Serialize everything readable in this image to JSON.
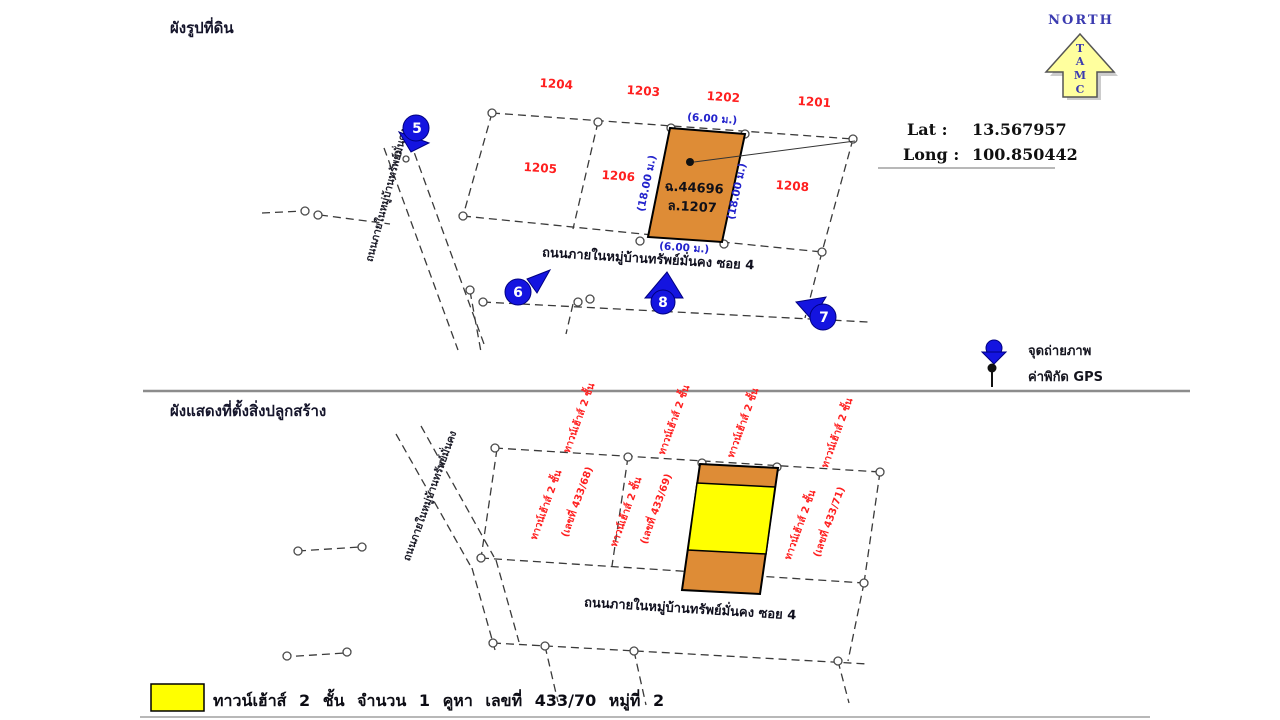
{
  "colors": {
    "parcel_red": "#ff1f1f",
    "dimension_blue": "#2323cc",
    "marker_blue": "#1414e0",
    "subject_plot_orange": "#de8c36",
    "subject_building_yellow": "#ffff00",
    "north_arrow_yellow": "#ffff9e"
  },
  "top": {
    "title": "ผังรูปที่ดิน",
    "north": {
      "label": "NORTH",
      "letters": [
        "T",
        "A",
        "M",
        "C"
      ]
    },
    "gps": {
      "lat_label": "Lat :",
      "lat_value": "13.567957",
      "long_label": "Long :",
      "long_value": "100.850442"
    },
    "parcels": {
      "p1201": "1201",
      "p1202": "1202",
      "p1203": "1203",
      "p1204": "1204",
      "p1205": "1205",
      "p1206": "1206",
      "p1208": "1208"
    },
    "subject": {
      "deed_no": "ฉ.44696",
      "parcel_no": "ล.1207",
      "width_top": "(6.00 ม.)",
      "width_bottom": "(6.00 ม.)",
      "depth_left": "(18.00 ม.)",
      "depth_right": "(18.00 ม.)"
    },
    "roads": {
      "vertical": "ถนนภายในหมู่บ้านทรัพย์มั่นคง",
      "horizontal": "ถนนภายในหมู่บ้านทรัพย์มั่นคง ซอย 4"
    },
    "photo_markers": {
      "m5": "5",
      "m6": "6",
      "m7": "7",
      "m8": "8"
    },
    "legend": {
      "photo_point": "จุดถ่ายภาพ",
      "gps_point": "ค่าพิกัด GPS"
    }
  },
  "bottom": {
    "title": "ผังแสดงที่ตั้งสิ่งปลูกสร้าง",
    "row_labels": [
      "ทาวน์เฮ้าส์ 2 ชั้น",
      "ทาวน์เฮ้าส์ 2 ชั้น",
      "ทาวน์เฮ้าส์ 2 ชั้น",
      "ทาวน์เฮ้าส์ 2 ชั้น"
    ],
    "units": [
      {
        "name": "ทาวน์เฮ้าส์ 2 ชั้น",
        "number": "(เลขที่ 433/68)"
      },
      {
        "name": "ทาวน์เฮ้าส์ 2 ชั้น",
        "number": "(เลขที่ 433/69)"
      },
      {
        "name": "ทาวน์เฮ้าส์ 2 ชั้น",
        "number": "(เลขที่ 433/71)"
      }
    ],
    "roads": {
      "vertical": "ถนนภายในหมู่บ้านทรัพย์มั่นคง",
      "horizontal": "ถนนภายในหมู่บ้านทรัพย์มั่นคง ซอย 4"
    },
    "legend": {
      "text": "ทาวน์เฮ้าส์ 2 ชั้น จำนวน 1 คูหา เลขที่ 433/70 หมู่ที่ 2"
    }
  }
}
